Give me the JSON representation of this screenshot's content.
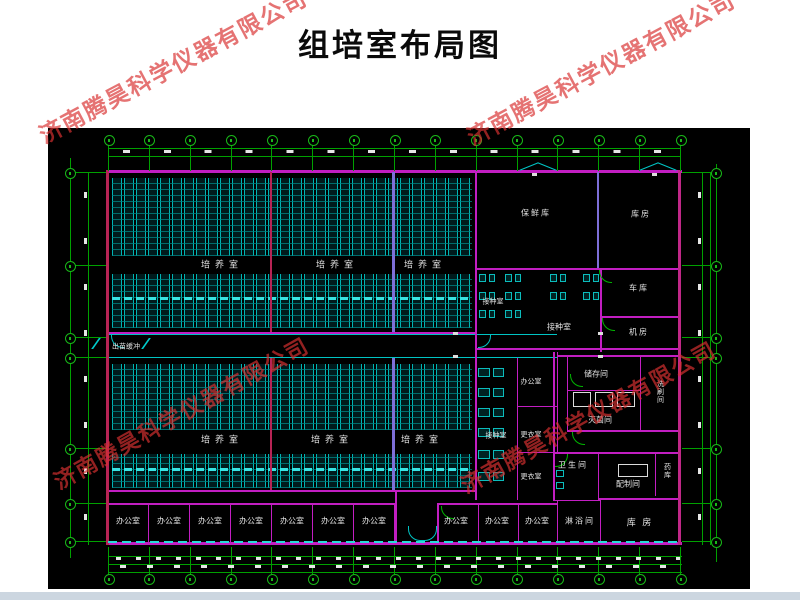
{
  "title": "组培室布局图",
  "watermark": "济南腾昊科学仪器有限公司",
  "rooms": {
    "culture": "培养室",
    "inoculation": "接种室",
    "fresh_keeping": "保鲜库",
    "warehouse": "库房",
    "warehouse_spaced": "库 房",
    "garage": "车库",
    "machine": "机房",
    "office": "办公室",
    "changing": "更衣室",
    "storage": "储存间",
    "sterilize": "灭菌间",
    "washing": "洗刷间",
    "toilet": "卫生间",
    "prep": "配制间",
    "medicine": "药库",
    "shower": "淋浴间",
    "buffer": "出苗缓冲"
  }
}
